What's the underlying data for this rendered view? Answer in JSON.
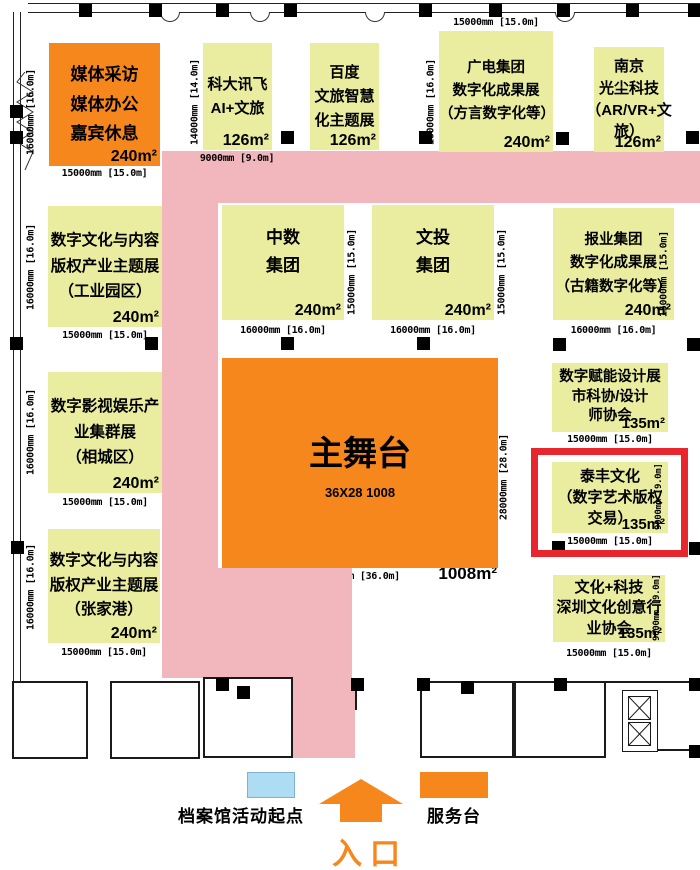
{
  "stage": {
    "name": "主舞台",
    "spec": "36X28  1008",
    "area": "1008m²",
    "dim_right": "28000mm [28.0m]",
    "dim_bottom": "36000mm [36.0m]"
  },
  "booths": {
    "media": {
      "lines": [
        "媒体采访",
        "媒体办公",
        "嘉宾休息"
      ],
      "area": "240m²",
      "dim_left": "16000mm [16.0m]",
      "dim_bottom": "15000mm [15.0m]"
    },
    "iflytek": {
      "lines": [
        "科大讯飞",
        "AI+文旅"
      ],
      "area": "126m²",
      "dim_left": "14000mm [14.0m]",
      "dim_bottom": "9000mm [9.0m]"
    },
    "baidu": {
      "lines": [
        "百度",
        "文旅智慧",
        "化主题展"
      ],
      "area": "126m²"
    },
    "guangdian": {
      "lines": [
        "广电集团",
        "数字化成果展",
        "（方言数字化等）"
      ],
      "area": "240m²",
      "dim_top": "15000mm [15.0m]",
      "dim_left": "16000mm [16.0m]"
    },
    "nanjing": {
      "lines": [
        "南京",
        "光尘科技",
        "（AR/VR+文",
        "旅）"
      ],
      "area": "126m²"
    },
    "industry_park": {
      "lines": [
        "数字文化与内容",
        "版权产业主题展",
        "（工业园区）"
      ],
      "area": "240m²",
      "dim_left": "16000mm [16.0m]",
      "dim_bottom": "15000mm [15.0m]"
    },
    "zhongshu": {
      "lines": [
        "中数",
        "集团"
      ],
      "area": "240m²",
      "dim_right": "15000mm [15.0m]",
      "dim_bottom": "16000mm [16.0m]"
    },
    "wentou": {
      "lines": [
        "文投",
        "集团"
      ],
      "area": "240m²",
      "dim_right": "15000mm [15.0m]",
      "dim_bottom": "16000mm [16.0m]"
    },
    "baoye": {
      "lines": [
        "报业集团",
        "数字化成果展",
        "（古籍数字化等）"
      ],
      "area": "240m²",
      "dim_right": "15000mm [15.0m]",
      "dim_bottom": "16000mm [16.0m]"
    },
    "xiangcheng": {
      "lines": [
        "数字影视娱乐产",
        "业集群展",
        "（相城区）"
      ],
      "area": "240m²",
      "dim_left": "16000mm [16.0m]",
      "dim_bottom": "15000mm [15.0m]"
    },
    "sheji": {
      "lines": [
        "数字赋能设计展",
        "市科协/设计",
        "师协会"
      ],
      "area": "135m²",
      "dim_bottom": "15000mm [15.0m]"
    },
    "taifeng": {
      "lines": [
        "泰丰文化",
        "（数字艺术版权",
        "交易）"
      ],
      "area": "135m²",
      "dim_right": "9000mm [9.0m]",
      "dim_bottom": "15000mm [15.0m]"
    },
    "zhangjiagang": {
      "lines": [
        "数字文化与内容",
        "版权产业主题展",
        "（张家港）"
      ],
      "area": "240m²",
      "dim_left": "16000mm [16.0m]",
      "dim_bottom": "15000mm [15.0m]"
    },
    "wenhua_keji": {
      "lines": [
        "文化+科技",
        "深圳文化创意行",
        "业协会"
      ],
      "area": "135m²",
      "dim_right": "9000mm [9.0m]",
      "dim_bottom": "15000mm [15.0m]"
    }
  },
  "legend": {
    "archive_label": "档案馆活动起点",
    "entrance_label": "入口",
    "service_label": "服务台"
  },
  "colors": {
    "booth_orange": "#F6871D",
    "booth_yellow": "#EAEDA0",
    "walkway_pink": "#F2B6BD",
    "highlight_red": "#E8262D",
    "legend_blue": "#AEDCF2"
  }
}
